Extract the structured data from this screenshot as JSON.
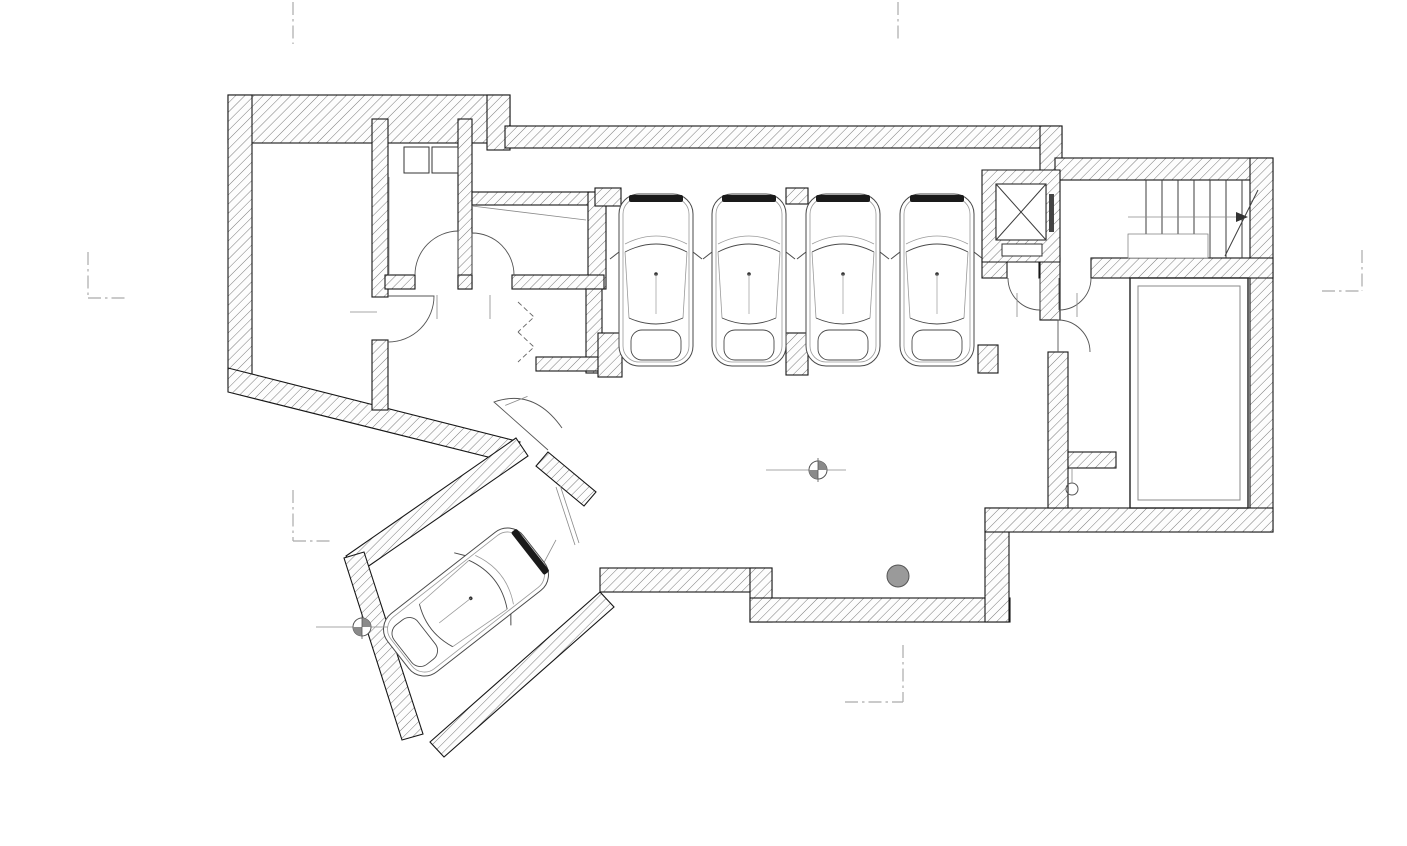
{
  "dimensions": {
    "top": {
      "overall": "2757",
      "segments": [
        "42",
        "339",
        "33",
        "197",
        "33",
        "302",
        "82",
        "447",
        "53",
        "454",
        "42",
        "160",
        "37",
        "488",
        "50"
      ]
    },
    "bottom": {
      "overall_front": "2787",
      "overall_back": "2757",
      "segments": [
        "279",
        "239",
        "188",
        "589",
        "267",
        "119",
        "690",
        "32",
        "542"
      ]
    },
    "left": {
      "overall": "1715",
      "segments": [
        "94",
        "650",
        "212",
        "293",
        "466"
      ]
    },
    "right": {
      "inner_segments": [
        "61",
        "190",
        "40",
        "648",
        "32",
        "230",
        "32"
      ],
      "outer_segments": [
        "1059",
        "261"
      ]
    }
  },
  "rooms": {
    "centrale": {
      "line1": "CENTRALE",
      "line2": "TERMICA",
      "area": "26,2 mq"
    },
    "lavanderia": {
      "name": "LAVANDERIA",
      "area": "7,30 mq"
    },
    "skiroom": {
      "name": "SKIROOM",
      "area": "6,90 mq"
    },
    "deposito_bici": {
      "name": "DEPOSITO BICI",
      "area": "16,0 mq"
    },
    "deposito_attrezzatura": {
      "line1": "DEPOSITO",
      "line2": "ATTREZZATURA",
      "line3": "SPORT"
    },
    "garage": {
      "name": "GARAGE",
      "area": "120,10 mq"
    },
    "disimpegno": {
      "name": "DISIMPEGNO",
      "area": "6,90 mq"
    },
    "spa": {
      "name": "SPA",
      "area": "32,70 mq"
    }
  },
  "doors": {
    "centrale": {
      "width": "90",
      "height": "220"
    },
    "lavanderia": {
      "width": "80",
      "height": "220"
    },
    "skiroom": {
      "width": "80",
      "height": "220"
    },
    "deposito": {
      "width": "80",
      "height": "220"
    },
    "disimpegno_left": {
      "width": "90",
      "height": "220"
    },
    "disimpegno_right": {
      "width": "90",
      "height": "220"
    },
    "ramp": {
      "width": "300",
      "height": "250"
    }
  },
  "levels": {
    "garage": "+0.45",
    "entrance": "+0.00"
  },
  "stairs": {
    "riser_note": "18 a = 17,23cm",
    "tread_note": "p = 30cm",
    "width": "95"
  },
  "section_markers": {
    "one": "1",
    "two": "2",
    "three": "3"
  },
  "colors": {
    "wall_hatch": "#7a7a7a",
    "line": "#161616",
    "dim_text": "#3a3a3a"
  }
}
